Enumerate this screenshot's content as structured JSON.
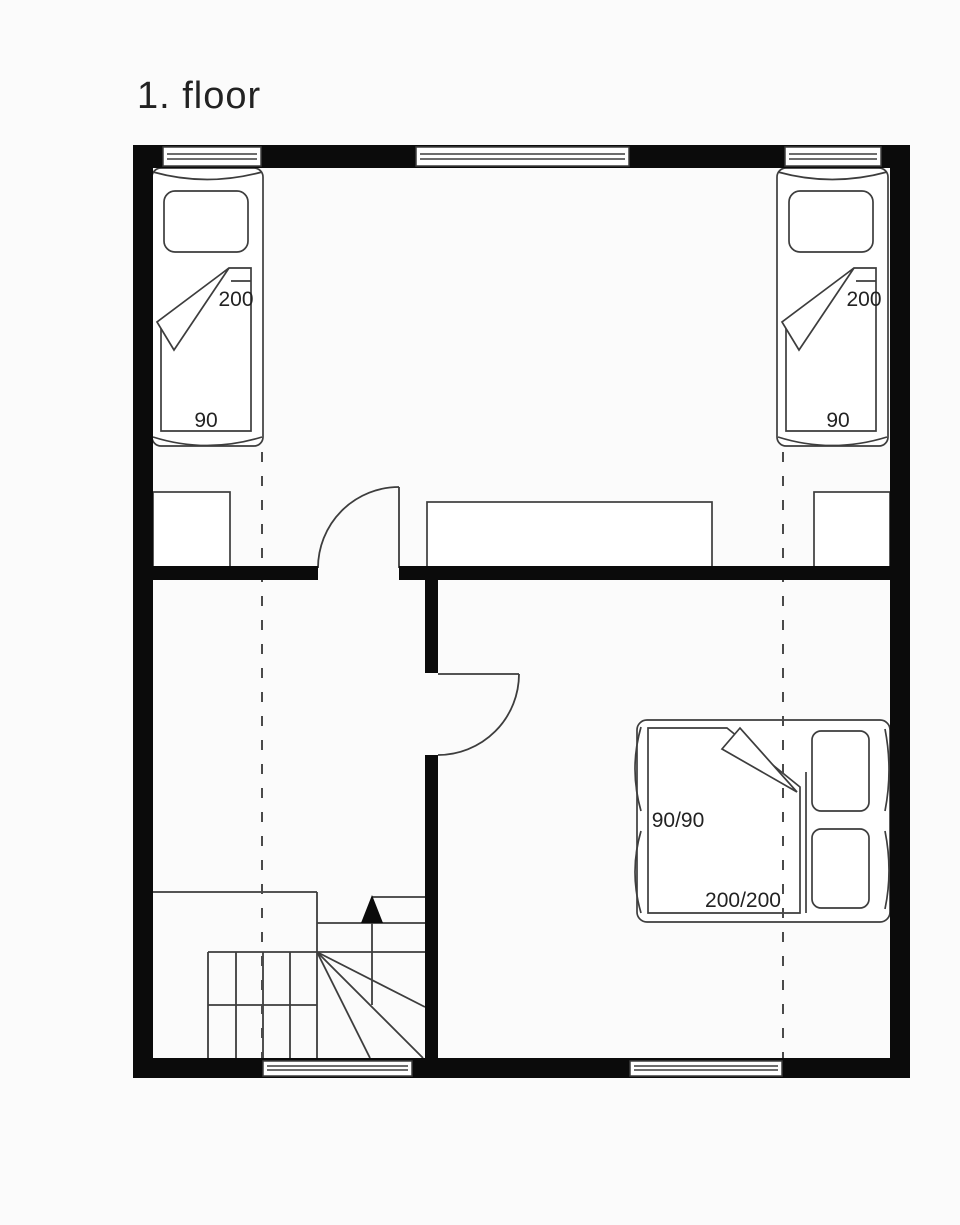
{
  "title": "1. floor",
  "colors": {
    "wall": "#0b0b0b",
    "line": "#3d3d3d",
    "dashed_line": "#4a4a4a",
    "text": "#222222",
    "paper": "#fbfbfb",
    "furniture_fill": "#ffffff"
  },
  "beds": {
    "single_left": {
      "length_label": "200",
      "width_label": "90"
    },
    "single_right": {
      "length_label": "200",
      "width_label": "90"
    },
    "double": {
      "pillow_label": "90/90",
      "size_label": "200/200"
    }
  },
  "icons": {
    "stair_direction_arrow": "up-triangle"
  }
}
